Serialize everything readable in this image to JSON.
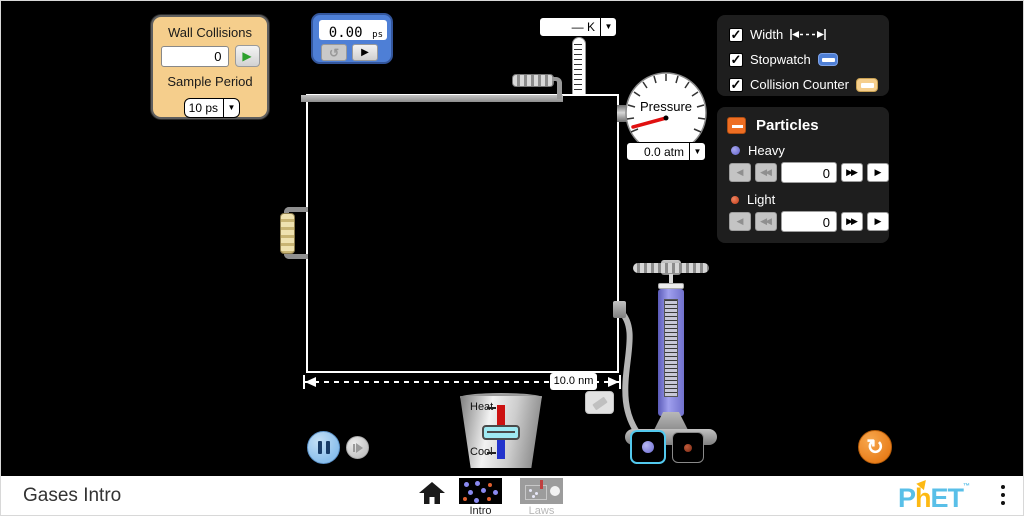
{
  "colors": {
    "accent_orange": "#EE6E23",
    "stopwatch_blue": "#4E7FD6",
    "counter_tan": "#F5CE8C",
    "heavy_particle": "#6A6AD0",
    "light_particle": "#C03A18",
    "selected_cyan": "#53C9EE",
    "phet_blue": "#59BFE8",
    "phet_yellow": "#FDB913"
  },
  "icons": {
    "check": "✓",
    "play": "▶",
    "caret_down": "▼",
    "reset": "↺",
    "reset_all": "↻",
    "step_left": "◀",
    "rewind_double": "◀◀",
    "forward_double": "▶▶",
    "step_right": "▶"
  },
  "collision_counter": {
    "title": "Wall Collisions",
    "count": "0",
    "sample_period_label": "Sample Period",
    "sample_period_value": "10 ps"
  },
  "stopwatch": {
    "time": "0.00",
    "unit": "ps"
  },
  "thermometer": {
    "unit_display": "— K"
  },
  "pressure_gauge": {
    "label": "Pressure",
    "value_display": "0.0 atm"
  },
  "view_options": {
    "items": [
      {
        "label": "Width"
      },
      {
        "label": "Stopwatch"
      },
      {
        "label": "Collision Counter"
      }
    ]
  },
  "particles_panel": {
    "title": "Particles",
    "heavy": {
      "label": "Heavy",
      "count": "0"
    },
    "light": {
      "label": "Light",
      "count": "0"
    }
  },
  "container": {
    "width_label": "10.0 nm"
  },
  "heater": {
    "heat_label": "Heat",
    "cool_label": "Cool"
  },
  "footer": {
    "sim_title": "Gases Intro",
    "tabs": [
      {
        "label": "Intro"
      },
      {
        "label": "Laws"
      }
    ],
    "logo": {
      "part1": "P",
      "part2": "h",
      "part3": "ET"
    }
  }
}
